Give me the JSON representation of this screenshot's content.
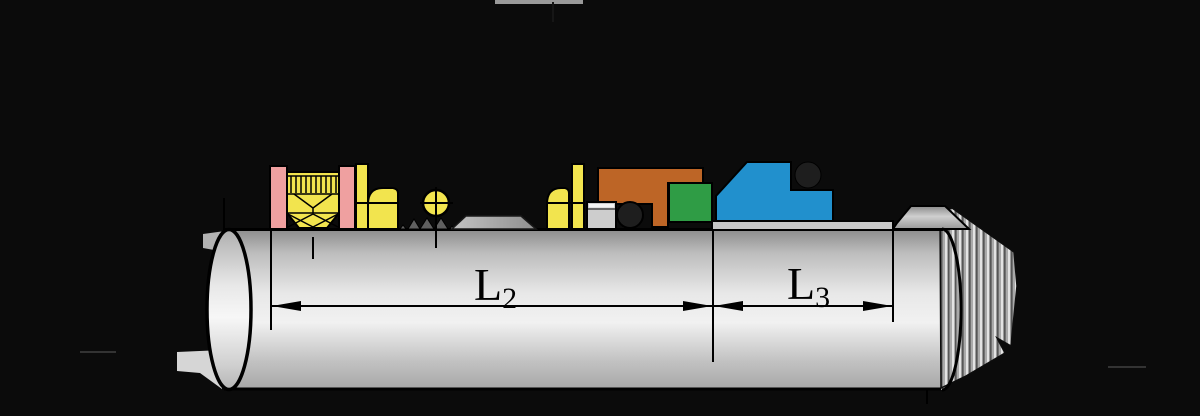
{
  "figure": {
    "kind": "mechanical-seal-cross-section-diagram",
    "dimensions": [
      {
        "id": "L2",
        "base": "L",
        "subscript": "2"
      },
      {
        "id": "L3",
        "base": "L",
        "subscript": "3"
      }
    ]
  },
  "colors": {
    "background": "#0b0b0b",
    "gland_pink": "#efa0a0",
    "seal_yellow": "#f2e44e",
    "retainer_orange": "#bd6526",
    "seat_green": "#2f9c45",
    "clamp_blue": "#2190cd",
    "oring_dark": "#1e1e1e",
    "line_black": "#000000"
  }
}
